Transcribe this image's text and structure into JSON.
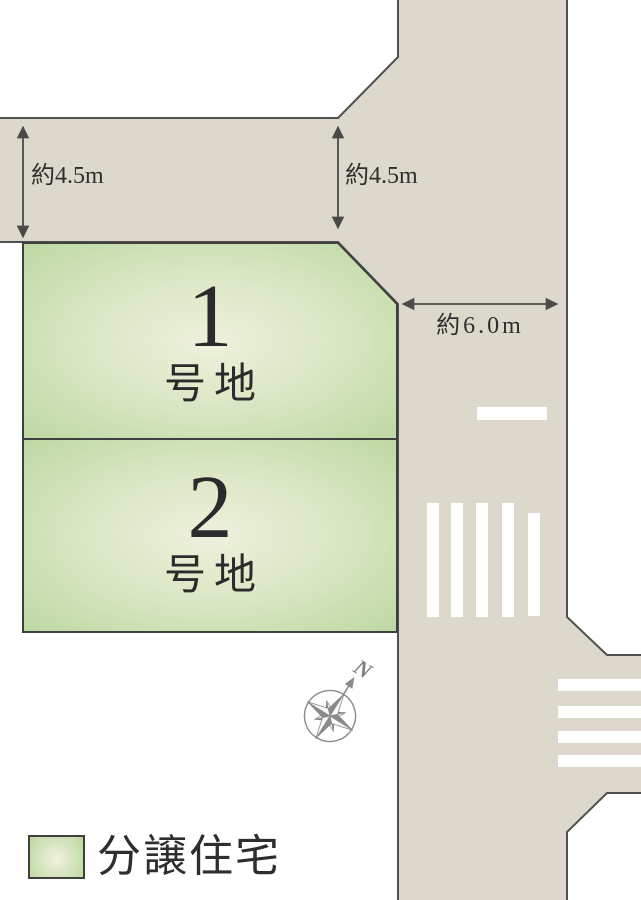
{
  "map": {
    "plots": [
      {
        "number": "1",
        "suffix": "号地"
      },
      {
        "number": "2",
        "suffix": "号地"
      }
    ],
    "measurements": [
      {
        "id": "north-road-width-left",
        "label": "約4.5m"
      },
      {
        "id": "north-road-width-right",
        "label": "約4.5m"
      },
      {
        "id": "east-road-width",
        "label": "約6.0m"
      }
    ],
    "compass": {
      "north_label": "N"
    }
  },
  "legend": {
    "label": "分譲住宅"
  },
  "colors": {
    "background": "#ffffff",
    "road_fill": "#dcd9cc",
    "road_edge": "#4f4f4f",
    "plot_fill_center": "#eef1dd",
    "plot_fill_edge": "#bcd7a1",
    "plot_border": "#3f3f3f",
    "road_marking": "#ffffff",
    "dimension_color": "#4a4a4a",
    "text": "#2e2e2e",
    "compass": "#8a8a8a"
  }
}
